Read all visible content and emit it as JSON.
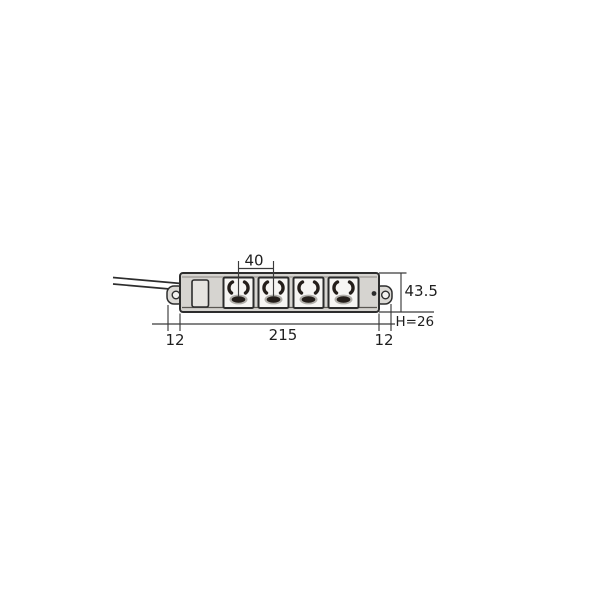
{
  "diagram": {
    "kind": "power-strip-dimension-drawing",
    "outlet_count": 4,
    "labels": {
      "outlet_pitch": "40",
      "overall_height": "43.5",
      "unit_height": "H=26",
      "body_length": "215",
      "left_end_margin": "12",
      "right_end_margin": "12"
    },
    "colors": {
      "background": "#ffffff",
      "body_fill": "#d6d4d0",
      "ear_fill": "#dcdad6",
      "plate_fill": "#e6e4e0",
      "outlet_face": "#f6f5f3",
      "hole_fill": "#f2f1ef",
      "line": "#2d2d2d",
      "dim_line": "#3a3a3a",
      "slot": "#241e1a",
      "slot_halo": "#9a9792"
    }
  }
}
